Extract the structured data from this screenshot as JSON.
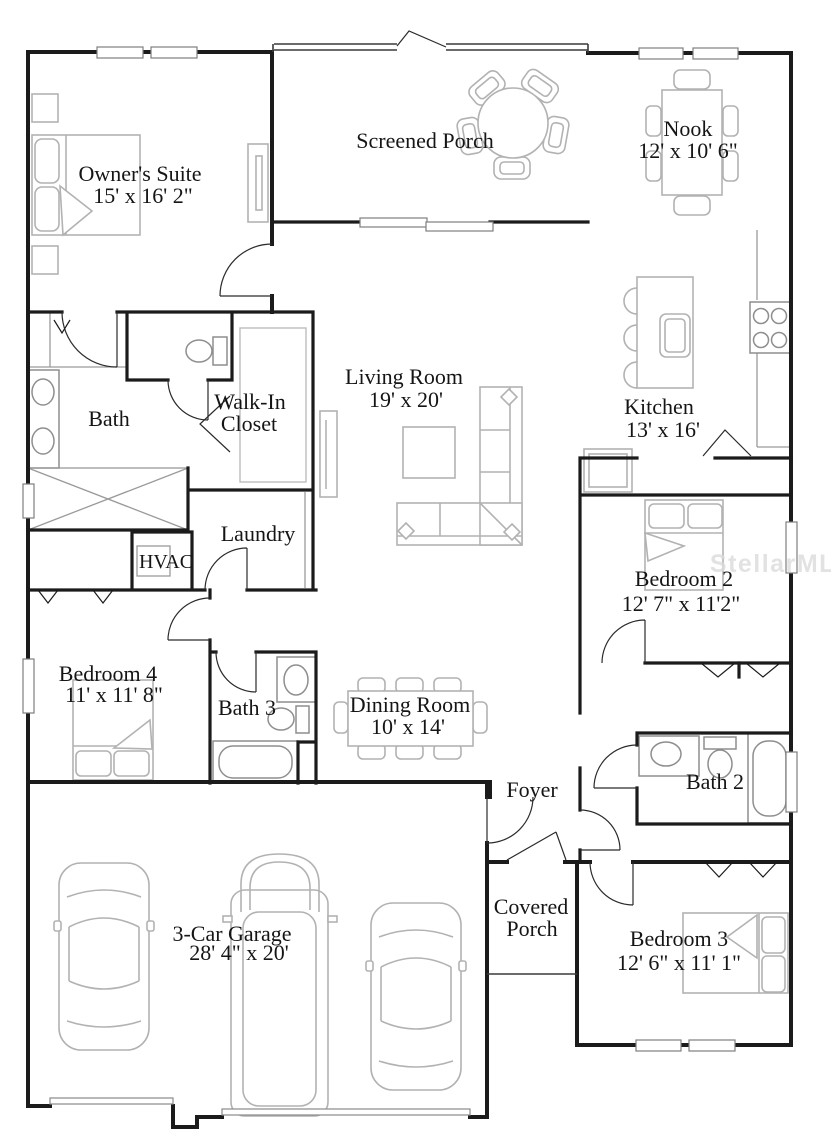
{
  "watermark": "StellarMLS",
  "rooms": {
    "owners_suite": {
      "name": "Owner's Suite",
      "dims": "15' x 16' 2\""
    },
    "screened_porch": {
      "name": "Screened Porch"
    },
    "nook": {
      "name": "Nook",
      "dims": "12' x 10' 6\""
    },
    "bath": {
      "name": "Bath"
    },
    "walk_in_closet": {
      "line1": "Walk-In",
      "line2": "Closet"
    },
    "living_room": {
      "name": "Living Room",
      "dims": "19' x 20'"
    },
    "kitchen": {
      "name": "Kitchen",
      "dims": "13' x 16'"
    },
    "laundry": {
      "name": "Laundry"
    },
    "hvac": {
      "name": "HVAC"
    },
    "bedroom_2": {
      "name": "Bedroom 2",
      "dims": "12' 7\" x 11'2\""
    },
    "bedroom_4": {
      "name": "Bedroom 4",
      "dims": "11' x 11' 8\""
    },
    "bath_3": {
      "name": "Bath 3"
    },
    "dining_room": {
      "name": "Dining Room",
      "dims": "10' x 14'"
    },
    "foyer": {
      "name": "Foyer"
    },
    "bath_2": {
      "name": "Bath 2"
    },
    "garage": {
      "name": "3-Car Garage",
      "dims": "28' 4\" x 20'"
    },
    "covered_porch": {
      "line1": "Covered",
      "line2": "Porch"
    },
    "bedroom_3": {
      "name": "Bedroom 3",
      "dims": "12' 6\" x 11' 1\""
    }
  },
  "colors": {
    "walls": "#1b1b1b",
    "furniture": "#b2b2b2",
    "fixtures": "#8e8e8e",
    "text": "#151515",
    "watermark": "#dcdcdc",
    "background": "#ffffff"
  }
}
